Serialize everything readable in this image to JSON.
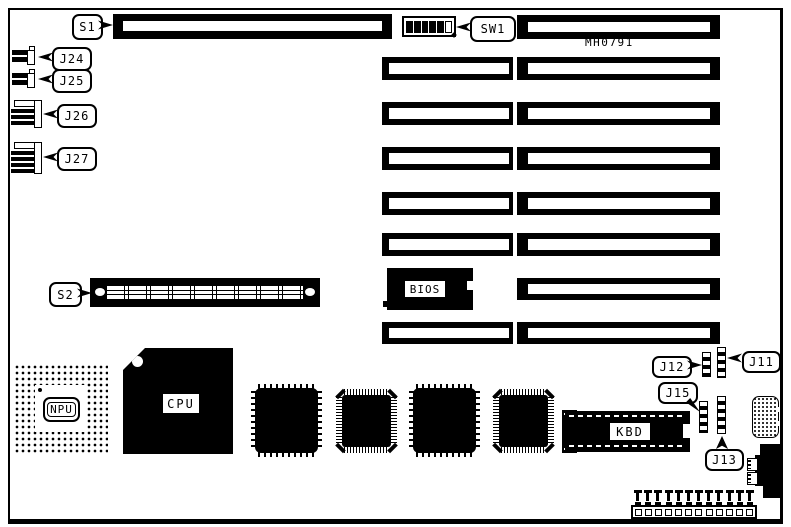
{
  "board": {
    "code": "MH0791",
    "ink": "#000000",
    "paper": "#ffffff"
  },
  "callouts": {
    "s1": "S1",
    "sw1": "SW1",
    "s2": "S2",
    "j24": "J24",
    "j25": "J25",
    "j26": "J26",
    "j27": "J27",
    "j11": "J11",
    "j12": "J12",
    "j13": "J13",
    "j15": "J15"
  },
  "chips": {
    "bios": "BIOS",
    "npu": "NPU",
    "cpu": "CPU",
    "kbd": "KBD"
  },
  "sw1_dip": {
    "positions": 6,
    "pattern": [
      1,
      1,
      1,
      1,
      1,
      0
    ]
  },
  "power_connector": {
    "pin_count": 12
  }
}
